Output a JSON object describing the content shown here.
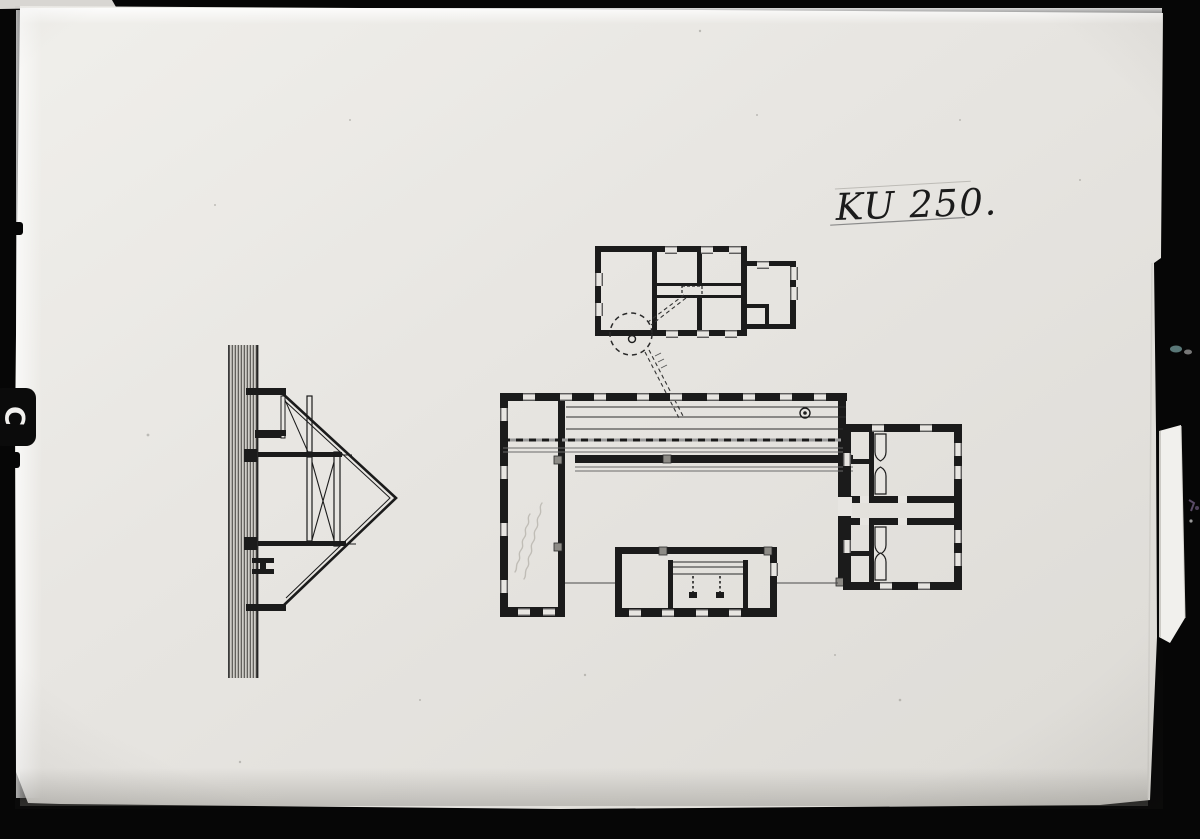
{
  "photo": {
    "label": "KU 250.",
    "film_tab_glyph": "C",
    "colors": {
      "background": "#060606",
      "paper": "#e7e5e1",
      "paper-bright": "#f6f5f2",
      "paper-shadow": "#d6d4cf",
      "ink": "#1b1b1b",
      "pencil": "#bab7b0",
      "overlay-strip": "#f1f0ed",
      "speck-cyan": "#9fd6d6",
      "speck-purple": "#6f5d80"
    }
  }
}
